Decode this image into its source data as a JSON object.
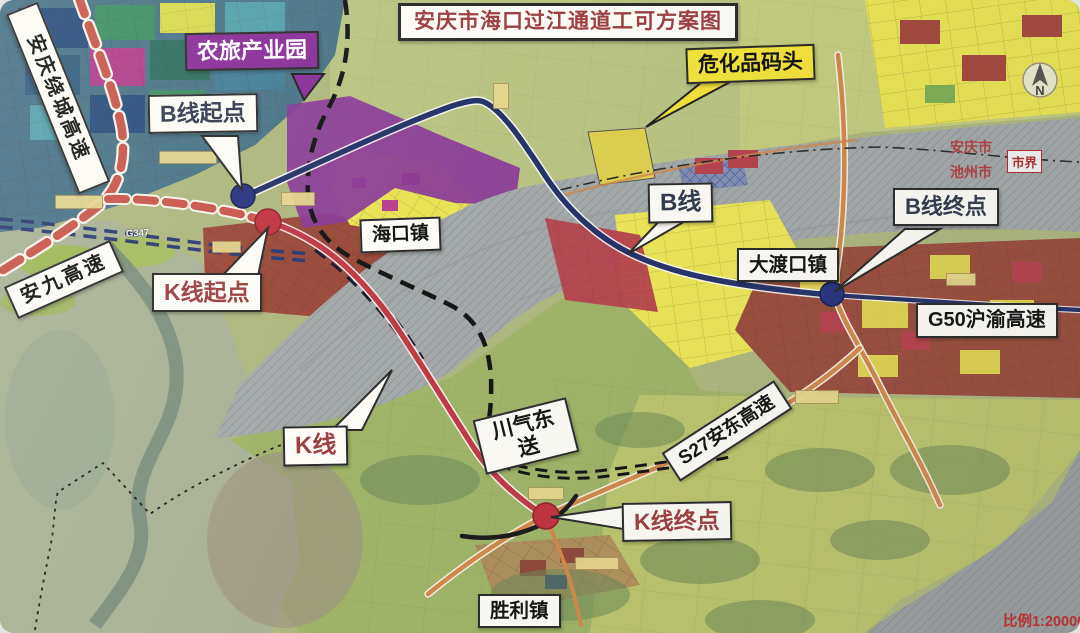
{
  "title": "安庆市海口过江通道工可方案图",
  "scale_note": "比例1:20000",
  "north_label": "N",
  "boundary": {
    "marker": "市界",
    "city_top": "安庆市",
    "city_bottom": "池州市"
  },
  "towns": {
    "haikou": "海口镇",
    "dadukou": "大渡口镇",
    "shengli": "胜利镇"
  },
  "zones": {
    "agri_park": "农旅产业园",
    "hazmat_dock": "危化品码头"
  },
  "roads": {
    "ring_expwy": "安庆绕城高速",
    "anjiu_expwy": "安九高速",
    "g50_expwy": "G50沪渝高速",
    "s27_expwy": "S27安东高速",
    "g347": "G347",
    "gas_pipeline": "川气东送"
  },
  "routes": {
    "b": {
      "name": "B线",
      "start": "B线起点",
      "end": "B线终点",
      "color": "#273468"
    },
    "k": {
      "name": "K线",
      "start": "K线起点",
      "end": "K线终点",
      "color": "#c03a44"
    }
  },
  "colors": {
    "ring_expwy_dash": "#c8574a",
    "agri_park_bg": "#8a2f99",
    "hazmat_bg": "#f2e23c",
    "river_gray": "#a4a9aa",
    "b_label_text": "#333d50",
    "k_label_text": "#9c4040",
    "title_text": "#9c4040"
  }
}
